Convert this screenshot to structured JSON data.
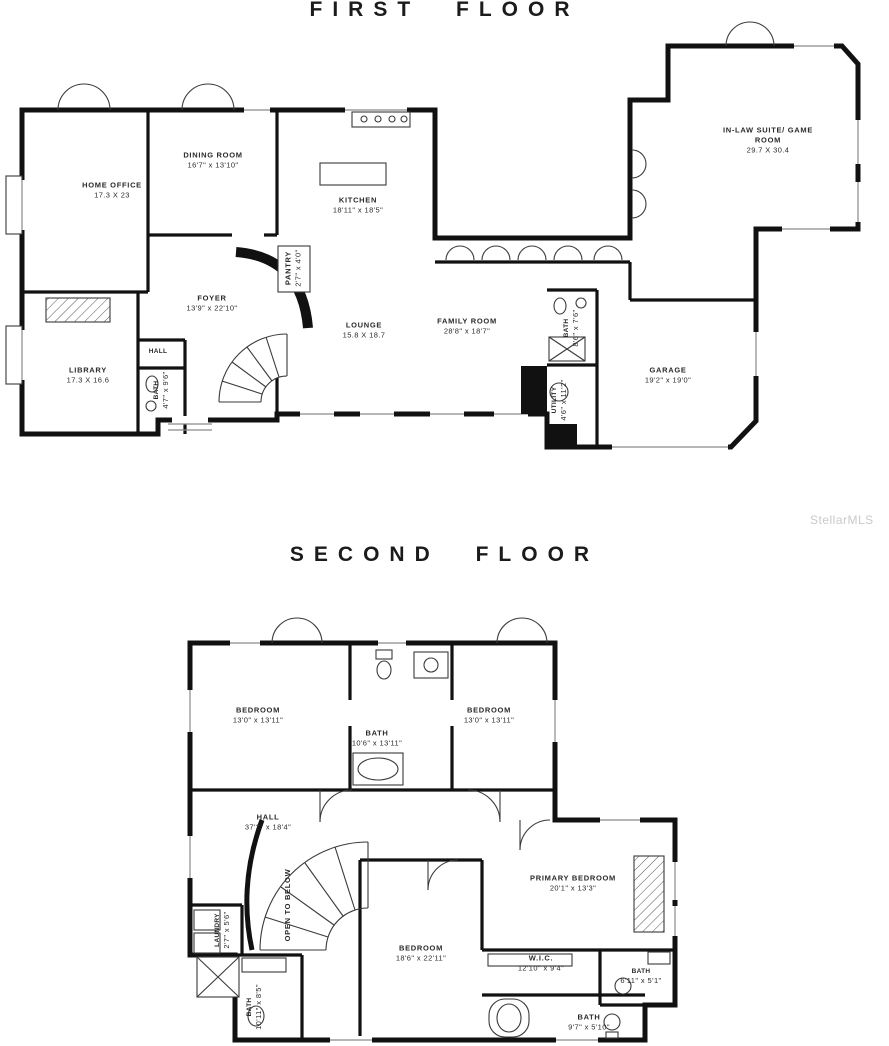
{
  "watermark": "StellarMLS",
  "colors": {
    "walls": "#111111",
    "labels": "#2a2a2a",
    "watermark": "#c9c9c9"
  },
  "floors": [
    {
      "title": "FIRST FLOOR",
      "rooms": [
        {
          "name": "HOME OFFICE",
          "dims": "17.3 X 23",
          "x": 112,
          "y": 190
        },
        {
          "name": "DINING ROOM",
          "dims": "16'7\" x 13'10\"",
          "x": 213,
          "y": 160
        },
        {
          "name": "KITCHEN",
          "dims": "18'11\" x 18'5\"",
          "x": 358,
          "y": 205
        },
        {
          "name": "IN-LAW SUITE/ GAME\nROOM",
          "dims": "29.7 X 30.4",
          "x": 768,
          "y": 140
        },
        {
          "name": "FOYER",
          "dims": "13'9\" x 22'10\"",
          "x": 212,
          "y": 303
        },
        {
          "name": "PANTRY",
          "dims": "2'7\" x 4'0\"",
          "x": 293,
          "y": 268,
          "rotate": 1
        },
        {
          "name": "LOUNGE",
          "dims": "15.8 X 18.7",
          "x": 364,
          "y": 330
        },
        {
          "name": "FAMILY ROOM",
          "dims": "28'8\" x 18'7\"",
          "x": 467,
          "y": 326
        },
        {
          "name": "LIBRARY",
          "dims": "17.3 X 16.6",
          "x": 88,
          "y": 375
        },
        {
          "name": "HALL",
          "dims": "",
          "x": 158,
          "y": 352,
          "small": 1
        },
        {
          "name": "BATH",
          "dims": "4'7\" x 9'6\"",
          "x": 162,
          "y": 390,
          "rotate": 1,
          "small": 1
        },
        {
          "name": "BATH",
          "dims": "8'6\" x 7'6\"",
          "x": 572,
          "y": 328,
          "rotate": 1,
          "small": 1
        },
        {
          "name": "UTILITY",
          "dims": "4'6\" x 11'2\"",
          "x": 560,
          "y": 400,
          "rotate": 1,
          "small": 1
        },
        {
          "name": "GARAGE",
          "dims": "19'2\" x 19'0\"",
          "x": 668,
          "y": 375
        }
      ]
    },
    {
      "title": "SECOND FLOOR",
      "rooms": [
        {
          "name": "BEDROOM",
          "dims": "13'0\" x 13'11\"",
          "x": 258,
          "y": 715
        },
        {
          "name": "BATH",
          "dims": "10'6\" x 13'11\"",
          "x": 377,
          "y": 738
        },
        {
          "name": "BEDROOM",
          "dims": "13'0\" x 13'11\"",
          "x": 489,
          "y": 715
        },
        {
          "name": "HALL",
          "dims": "37'2\" x 18'4\"",
          "x": 268,
          "y": 822
        },
        {
          "name": "OPEN TO BELOW",
          "dims": "",
          "x": 288,
          "y": 905,
          "rotate": 1
        },
        {
          "name": "LAUNDRY",
          "dims": "2'7\" x 5'6\"",
          "x": 223,
          "y": 930,
          "rotate": 1,
          "small": 1
        },
        {
          "name": "BEDROOM",
          "dims": "18'6\" x 22'11\"",
          "x": 421,
          "y": 953
        },
        {
          "name": "PRIMARY BEDROOM",
          "dims": "20'1\" x 13'3\"",
          "x": 573,
          "y": 883
        },
        {
          "name": "W.I.C.",
          "dims": "12'10\" x 9'4\"",
          "x": 541,
          "y": 963
        },
        {
          "name": "BATH",
          "dims": "6'11\" x 5'1\"",
          "x": 641,
          "y": 977,
          "small": 1
        },
        {
          "name": "BATH",
          "dims": "9'7\" x 5'10\"",
          "x": 589,
          "y": 1022
        },
        {
          "name": "BATH",
          "dims": "10'11\" x 8'5\"",
          "x": 255,
          "y": 1007,
          "rotate": 1,
          "small": 1
        }
      ]
    }
  ]
}
